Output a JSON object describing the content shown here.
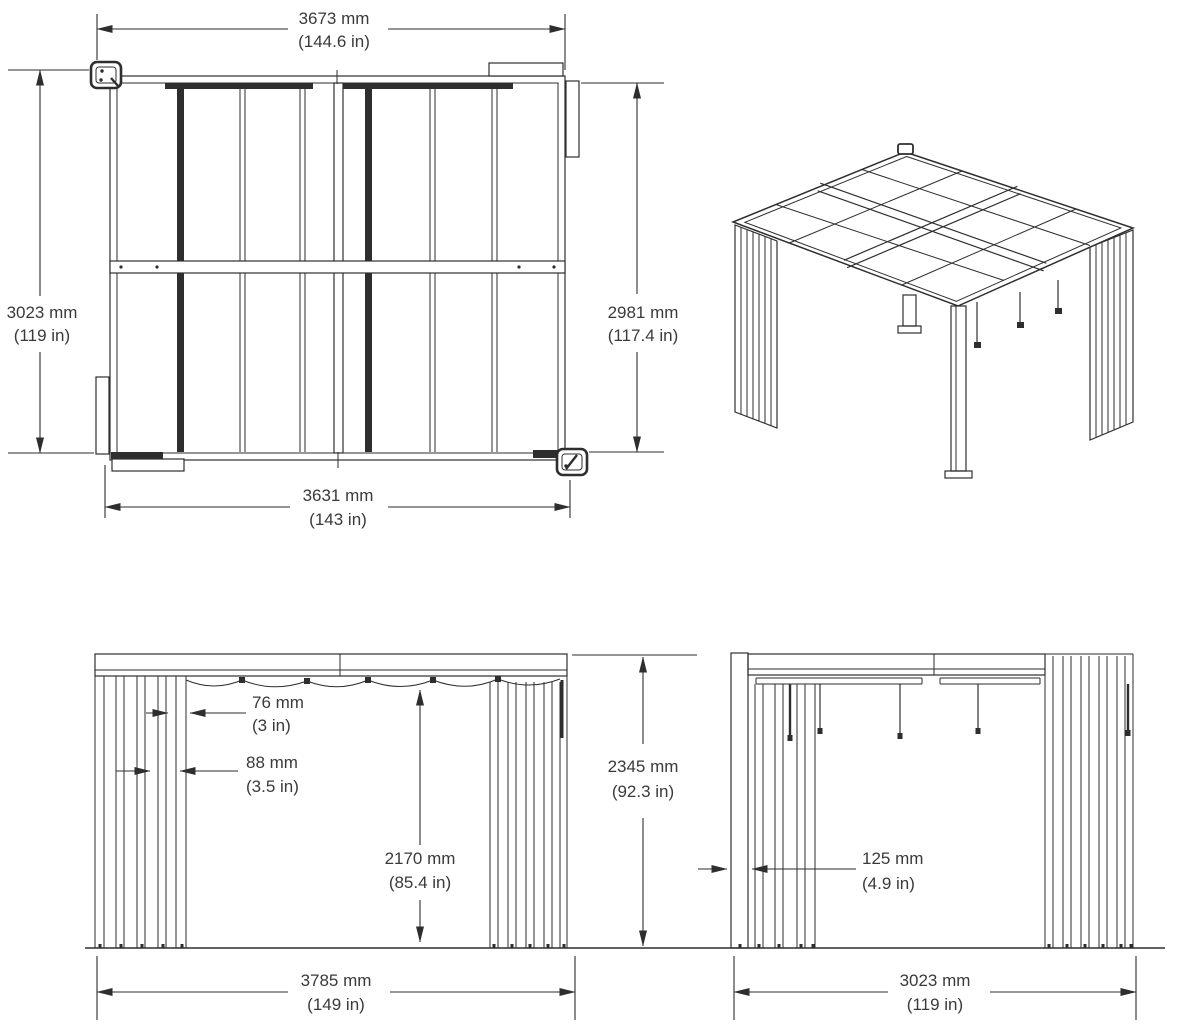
{
  "drawing": {
    "description": "Pergola dimensional drawing with plan view, isometric view, front elevation and side elevation",
    "theme": {
      "ink": "#2e2e2e",
      "text": "#3a3a3a",
      "background": "#ffffff"
    },
    "views": {
      "plan": {
        "dim_width_top": {
          "mm": "3673 mm",
          "in": "(144.6 in)"
        },
        "dim_depth_left": {
          "mm": "3023 mm",
          "in": "(119 in)"
        },
        "dim_depth_right": {
          "mm": "2981 mm",
          "in": "(117.4 in)"
        },
        "dim_width_bottom": {
          "mm": "3631 mm",
          "in": "(143 in)"
        }
      },
      "front": {
        "dim_slat_width": {
          "mm": "76 mm",
          "in": "(3 in)"
        },
        "dim_slat_spacing": {
          "mm": "88 mm",
          "in": "(3.5 in)"
        },
        "dim_clear_height": {
          "mm": "2170 mm",
          "in": "(85.4 in)"
        },
        "dim_overall_height": {
          "mm": "2345 mm",
          "in": "(92.3 in)"
        },
        "dim_overall_width": {
          "mm": "3785 mm",
          "in": "(149 in)"
        }
      },
      "side": {
        "dim_post_width": {
          "mm": "125 mm",
          "in": "(4.9 in)"
        },
        "dim_overall_width": {
          "mm": "3023 mm",
          "in": "(119 in)"
        }
      }
    }
  }
}
